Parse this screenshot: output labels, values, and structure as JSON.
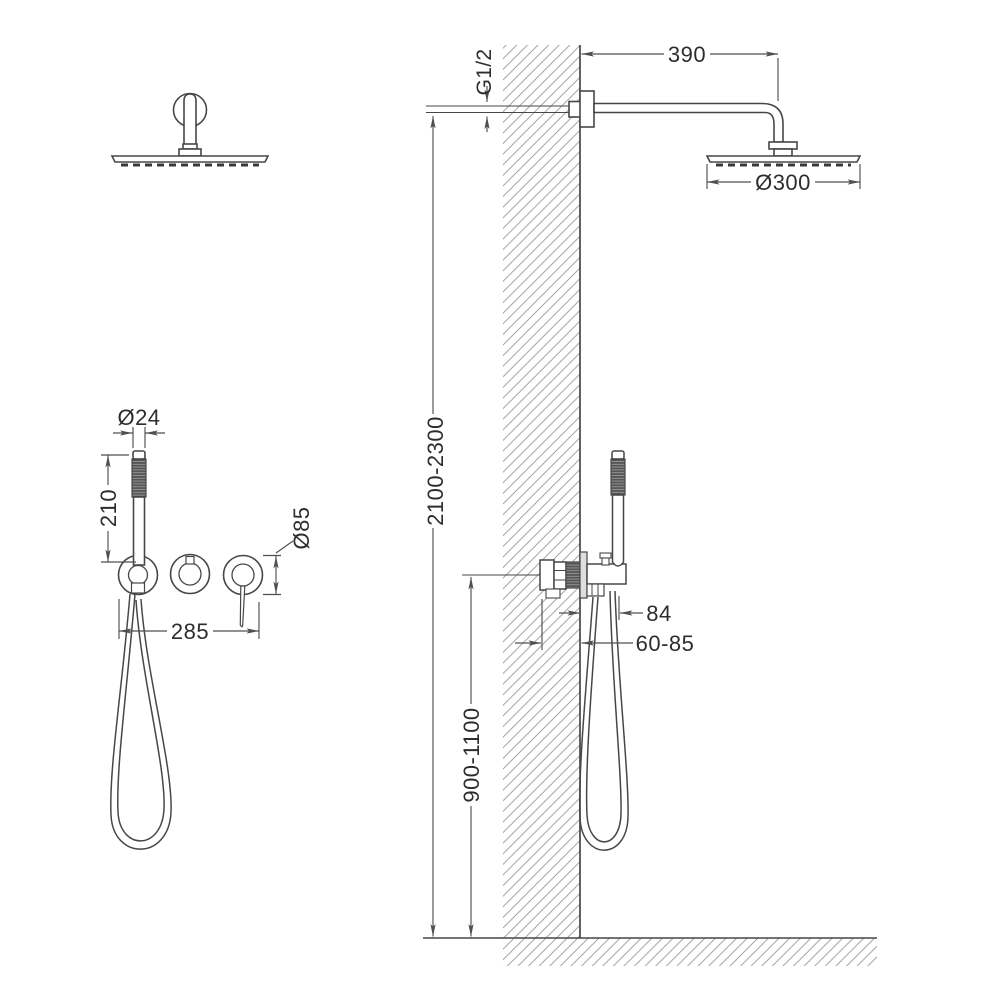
{
  "drawing": {
    "type": "shower-system-installation-diagram",
    "background": "#ffffff",
    "line_color": "#474747",
    "dim_color": "#4f4f4f",
    "hatch_color": "#979797",
    "labels": {
      "arm_length_mm": "390",
      "thread_size": "G1/2",
      "head_diameter": "Ø300",
      "mount_height_range": "2100-2300",
      "holder_projection": "84",
      "recess_depth_range": "60-85",
      "mixer_height_range": "900-1100",
      "handshower_diameter": "Ø24",
      "handshower_length": "210",
      "escutcheon_diameter": "Ø85",
      "trim_width": "285"
    }
  }
}
